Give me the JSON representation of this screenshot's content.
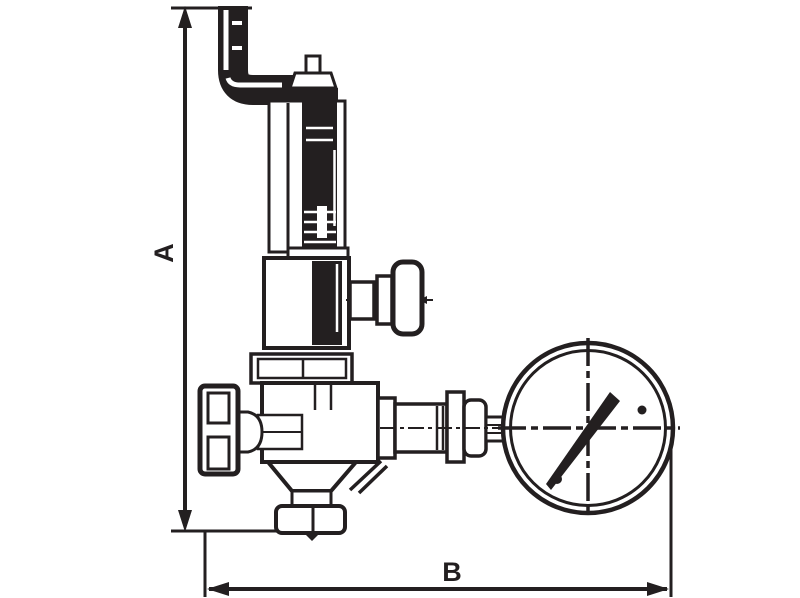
{
  "meta": {
    "description": "Technical line drawing of a bronze pressure reducing valve with pressure gauge and overall dimension callouts",
    "background_color": "#ffffff",
    "line_color": "#231f20",
    "fill_color": "#ffffff"
  },
  "dimensions": {
    "vertical": {
      "label": "A"
    },
    "horizontal": {
      "label": "B"
    }
  },
  "parts": {
    "inlet_pipe": "inlet-pipe-elbow",
    "adjusting_stem": "adjusting-stem",
    "adjusting_cap": "adjusting-cap-nut",
    "spring_housing": "spring-housing-tube",
    "bonnet": "spring-bonnet",
    "tee_handle": "tee-handle-valve",
    "flange": "bonnet-flange",
    "body": "valve-body",
    "handwheel": "inlet-handwheel",
    "bottom_flange": "bottom-outlet-flange",
    "outlet_fittings": "outlet-union-fittings",
    "gauge": "pressure-gauge",
    "needle": "gauge-needle"
  }
}
